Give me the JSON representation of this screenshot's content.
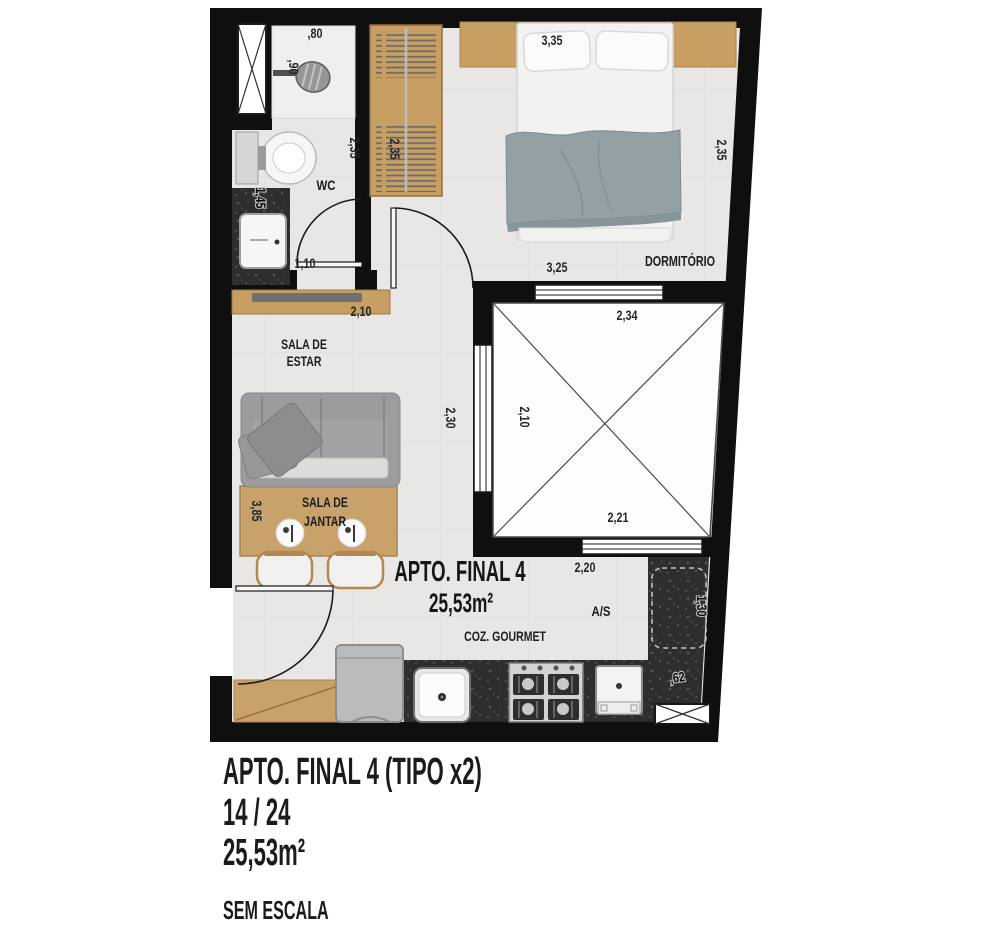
{
  "palette": {
    "wall": "#0f0f0f",
    "floor": "#e8e7e6",
    "wood": "#c79f63",
    "granite": "#2e2e2e",
    "blanket": "#93a1a5",
    "sofa": "#9b9b9d",
    "text": "#1c1c1c"
  },
  "plan": {
    "title": "APTO. FINAL 4",
    "area": "25,53m²",
    "rooms": {
      "wc": "WC",
      "dormitorio": "DORMITÓRIO",
      "sala_estar_line1": "SALA DE",
      "sala_estar_line2": "ESTAR",
      "sala_jantar_line1": "SALA DE",
      "sala_jantar_line2": "JANTAR",
      "cozinha": "COZ. GOURMET",
      "area_servico": "A/S"
    },
    "dims": {
      "d80": ",80",
      "d90": ",90",
      "d235_wc": "2,35",
      "d235_closet": "2,35",
      "d335": "3,35",
      "d235_dorm": "2,35",
      "d145": "1,45",
      "d110": "1,10",
      "d325": "3,25",
      "d210_rack": "2,10",
      "d234": "2,34",
      "d210_void": "2,10",
      "d230": "2,30",
      "d221": "2,21",
      "d220": "2,20",
      "d385": "3,85",
      "d130": "1,30",
      "d62": ",62"
    }
  },
  "caption": {
    "title": "APTO. FINAL 4 (TIPO x2)",
    "units": "14 / 24",
    "area": "25,53m²",
    "scale_note": "SEM ESCALA"
  }
}
